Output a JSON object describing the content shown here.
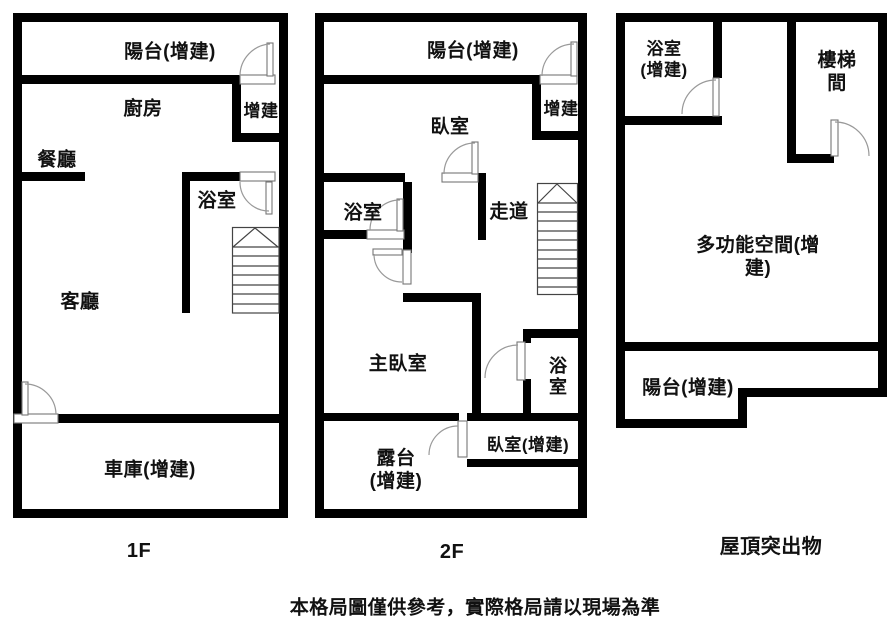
{
  "caption": "本格局圖僅供參考，實際格局請以現場為準",
  "colors": {
    "wall": "#000000",
    "thin_line": "#555555",
    "arc_line": "#999999",
    "text": "#111111",
    "background": "#ffffff"
  },
  "plans": [
    {
      "floor_label": "1F",
      "rooms": {
        "balcony": "陽台(增建)",
        "kitchen": "廚房",
        "addition": "增建",
        "dining": "餐廳",
        "bathroom": "浴室",
        "living": "客廳",
        "garage": "車庫(增建)"
      }
    },
    {
      "floor_label": "2F",
      "rooms": {
        "balcony": "陽台(增建)",
        "bedroom": "臥室",
        "addition": "增建",
        "bathroom": "浴室",
        "hallway": "走道",
        "master_bedroom": "主臥室",
        "bathroom_small": "浴室",
        "terrace": "露台\n(增建)",
        "bedroom_addition": "臥室(增建)"
      }
    },
    {
      "floor_label": "屋頂突出物",
      "rooms": {
        "bathroom": "浴室\n(增建)",
        "stairwell": "樓梯間",
        "multipurpose": "多功能空間(增建)",
        "balcony": "陽台(增建)"
      }
    }
  ]
}
